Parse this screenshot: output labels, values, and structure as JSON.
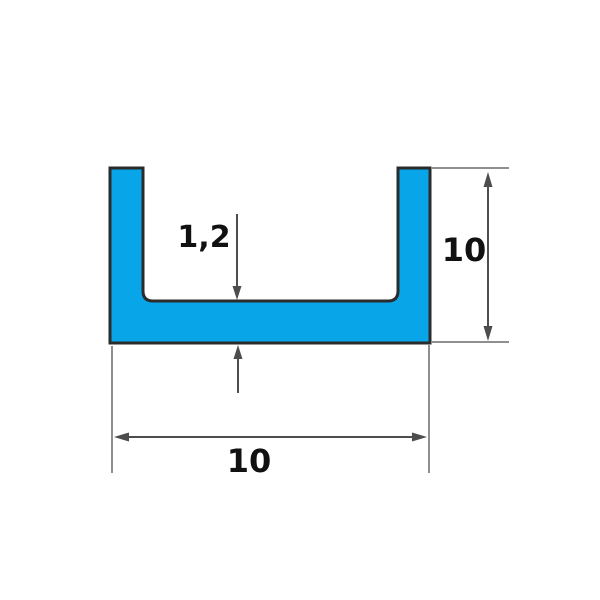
{
  "diagram": {
    "type": "technical-drawing",
    "subject": "U-channel profile cross-section with dimensions",
    "profile": {
      "shape": "u-channel",
      "fill_color": "#09A5E9",
      "outline_color": "#2B2B2B"
    },
    "lines": {
      "dimension_color": "#4D4D4D",
      "extension_color": "#8F8F8F"
    },
    "labels": {
      "thickness": "1,2",
      "height": "10",
      "width": "10"
    }
  }
}
